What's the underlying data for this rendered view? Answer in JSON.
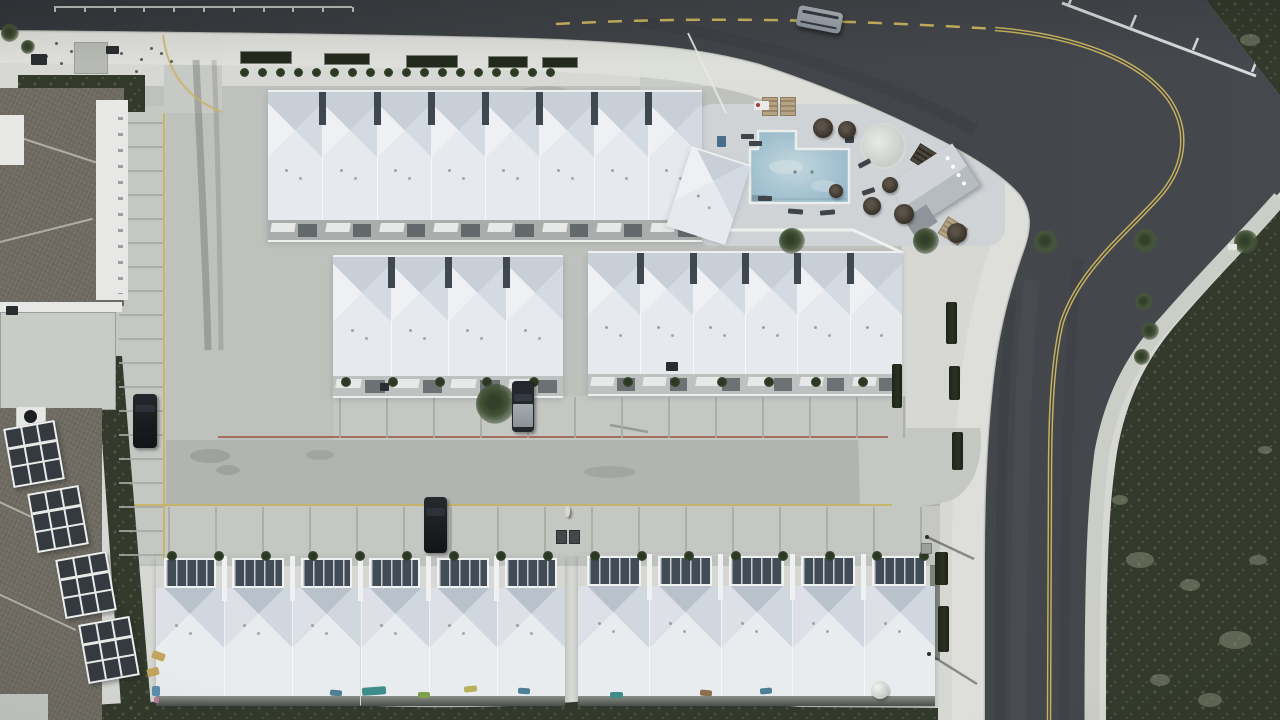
{
  "scene_label": "aerial-drone-view-beach-townhome-community",
  "palette": {
    "sand": "#d7d8d3",
    "sand2": "#dedfda",
    "lot": "#bfc1bd",
    "lotLight": "#c7c9c5",
    "aisle": "#b1b4b0",
    "apron": "#c5c7c3",
    "sidewalk": "#cbcdc7",
    "deckPave": "#cfd3d6",
    "road": "#3c3f43",
    "roadDark": "#34373b",
    "roadLight": "#4a4e52",
    "scrub": "#333a2b",
    "shingle": "#6f6b62",
    "roofN": "#c9cfd7",
    "roofE": "#d4dae1",
    "roofS": "#e6eaee",
    "roofW": "#eef0f3",
    "roofN2": "#b9c1cb",
    "deckDark": "#424c57",
    "water": "#a3c2d0",
    "waterLight": "#c4d7de",
    "yellow": "#c9b35e",
    "red": "#9e5a47",
    "whiteline": "#d8dbdc",
    "palm": "#46543a",
    "palmDark": "#32402b",
    "hedge": "#242a1d",
    "tan": "#b3a07f",
    "carSilver": "#9ba1a8",
    "carBlack": "#17191c"
  },
  "rows": [
    {
      "id": "row-top",
      "x": 268,
      "y": 90,
      "w": 434,
      "h": 150,
      "units": 8,
      "kind": "north",
      "roofH": 128,
      "garage": true,
      "gdark": true
    },
    {
      "id": "row-top-end",
      "x": 692,
      "y": 146,
      "w": 62,
      "h": 82,
      "units": 1,
      "kind": "north",
      "roofH": 82,
      "garage": false,
      "rot": 18
    },
    {
      "id": "row-mid-left",
      "x": 333,
      "y": 255,
      "w": 230,
      "h": 141,
      "units": 4,
      "kind": "north",
      "roofH": 119,
      "garage": true
    },
    {
      "id": "row-mid-right",
      "x": 588,
      "y": 251,
      "w": 314,
      "h": 143,
      "units": 6,
      "kind": "north",
      "roofH": 121,
      "garage": true
    },
    {
      "id": "row-bottom-left",
      "x": 156,
      "y": 556,
      "w": 409,
      "h": 150,
      "units": 6,
      "kind": "south"
    },
    {
      "id": "row-bottom-right",
      "x": 578,
      "y": 554,
      "w": 357,
      "h": 152,
      "units": 5,
      "kind": "south"
    }
  ],
  "balconies": {
    "w": 52,
    "h": 60,
    "list": [
      [
        8,
        424,
        -10
      ],
      [
        32,
        489,
        -10
      ],
      [
        60,
        555,
        -10
      ],
      [
        83,
        620,
        -10
      ]
    ]
  },
  "structures": [
    {
      "type": "pergola-tan",
      "x": 762,
      "y": 97,
      "w": 16,
      "h": 19,
      "rot": 0
    },
    {
      "type": "pergola-tan",
      "x": 780,
      "y": 97,
      "w": 16,
      "h": 19,
      "rot": 0
    },
    {
      "type": "pergola-dark",
      "x": 913,
      "y": 149,
      "w": 28,
      "h": 20,
      "rot": 32
    },
    {
      "type": "shade-tan",
      "x": 941,
      "y": 221,
      "w": 24,
      "h": 20,
      "rot": 32
    },
    {
      "type": "clubhouse",
      "x": 896,
      "y": 160,
      "w": 76,
      "h": 50,
      "rot": -33
    },
    {
      "type": "spa",
      "x": 860,
      "y": 123,
      "w": 46,
      "h": 46,
      "rot": 0
    }
  ],
  "palms": [
    [
      750,
      90,
      13
    ],
    [
      772,
      95,
      14
    ],
    [
      799,
      110,
      13
    ],
    [
      826,
      116,
      12
    ],
    [
      852,
      118,
      12
    ],
    [
      874,
      128,
      11
    ],
    [
      897,
      137,
      12
    ],
    [
      916,
      147,
      11
    ],
    [
      966,
      117,
      14
    ],
    [
      988,
      131,
      12
    ],
    [
      978,
      172,
      15
    ],
    [
      996,
      206,
      14
    ],
    [
      1002,
      240,
      12
    ],
    [
      986,
      263,
      12
    ],
    [
      915,
      247,
      12
    ],
    [
      906,
      271,
      12
    ],
    [
      898,
      292,
      11
    ],
    [
      396,
      241,
      13
    ],
    [
      463,
      241,
      13
    ],
    [
      523,
      242,
      12
    ],
    [
      573,
      241,
      12
    ],
    [
      623,
      242,
      12
    ],
    [
      673,
      241,
      12
    ],
    [
      572,
      302,
      9
    ],
    [
      575,
      331,
      9
    ],
    [
      571,
      357,
      8
    ],
    [
      248,
      404,
      20
    ],
    [
      5,
      33,
      9
    ],
    [
      14,
      47,
      7
    ]
  ],
  "umbrellas": [
    [
      823,
      128,
      10
    ],
    [
      847,
      130,
      9
    ],
    [
      890,
      185,
      8
    ],
    [
      872,
      206,
      9
    ],
    [
      904,
      214,
      10
    ],
    [
      957,
      233,
      10
    ],
    [
      836,
      191,
      7
    ]
  ],
  "loungers": [
    [
      741,
      134,
      13,
      5,
      0
    ],
    [
      749,
      141,
      13,
      5,
      0
    ],
    [
      858,
      161,
      13,
      5,
      -28
    ],
    [
      862,
      189,
      13,
      5,
      -18
    ],
    [
      788,
      209,
      15,
      5,
      4
    ],
    [
      820,
      210,
      15,
      5,
      -5
    ],
    [
      845,
      136,
      9,
      7,
      0
    ],
    [
      758,
      196,
      14,
      5,
      0
    ]
  ],
  "planters": [
    [
      240,
      51,
      52,
      13
    ],
    [
      324,
      53,
      46,
      12
    ],
    [
      406,
      55,
      52,
      13
    ],
    [
      488,
      56,
      40,
      12
    ],
    [
      542,
      57,
      36,
      11
    ]
  ],
  "bush_rows": [
    {
      "y": 72,
      "x0": 244,
      "x1": 562,
      "step": 18,
      "r": 4.5,
      "skip": [
        0,
        0
      ]
    },
    {
      "y": 382,
      "x0": 346,
      "x1": 902,
      "step": 47,
      "r": 5,
      "skip": [
        556,
        600
      ]
    },
    {
      "y": 556,
      "x0": 172,
      "x1": 924,
      "step": 47,
      "r": 5,
      "skip": [
        560,
        582
      ]
    }
  ],
  "hedges": [
    [
      892,
      364,
      10,
      44
    ],
    [
      946,
      302,
      11,
      42
    ],
    [
      949,
      366,
      11,
      34
    ],
    [
      952,
      432,
      11,
      38
    ],
    [
      935,
      552,
      13,
      33
    ],
    [
      938,
      606,
      11,
      46
    ]
  ],
  "stall_lines": [
    {
      "dir": "v",
      "x0": 339,
      "step": 47,
      "count": 13,
      "y": 397,
      "len": 41
    },
    {
      "dir": "v",
      "x0": 168,
      "step": 47,
      "count": 17,
      "y": 507,
      "len": 47
    },
    {
      "dir": "h",
      "y0": 122,
      "step": 24,
      "count": 19,
      "x": 119,
      "len": 44
    }
  ],
  "vehicles": [
    {
      "kind": "suv-silver",
      "x": 797,
      "y": 9,
      "w": 45,
      "h": 21,
      "rot": 11
    },
    {
      "kind": "car-black",
      "x": 133,
      "y": 394,
      "w": 24,
      "h": 54,
      "rot": 0
    },
    {
      "kind": "pickup",
      "x": 512,
      "y": 381,
      "w": 22,
      "h": 51,
      "rot": 0
    },
    {
      "kind": "suv-black",
      "x": 424,
      "y": 497,
      "w": 23,
      "h": 56,
      "rot": 0
    }
  ],
  "person": {
    "x": 565,
    "y": 506
  },
  "objects": [
    {
      "type": "pad",
      "x": 74,
      "y": 42,
      "w": 34,
      "h": 32
    },
    {
      "type": "dark",
      "x": 31,
      "y": 54,
      "w": 16,
      "h": 11
    },
    {
      "type": "dark",
      "x": 106,
      "y": 46,
      "w": 13,
      "h": 8
    },
    {
      "type": "blue",
      "x": 717,
      "y": 136,
      "w": 9,
      "h": 11
    },
    {
      "type": "cart",
      "x": 754,
      "y": 101,
      "w": 15,
      "h": 9
    },
    {
      "type": "bins",
      "x": 556,
      "y": 530,
      "w": 26,
      "h": 16
    },
    {
      "type": "sign",
      "x": 1228,
      "y": 244,
      "w": 9,
      "h": 6
    },
    {
      "type": "dome",
      "x": 871,
      "y": 681,
      "w": 18,
      "h": 18
    },
    {
      "type": "dark",
      "x": 666,
      "y": 362,
      "w": 12,
      "h": 9
    },
    {
      "type": "dark",
      "x": 380,
      "y": 383,
      "w": 9,
      "h": 8
    },
    {
      "type": "utility",
      "x": 921,
      "y": 543,
      "w": 11,
      "h": 11
    },
    {
      "type": "dot",
      "x": 925,
      "y": 535,
      "w": 4,
      "h": 4
    },
    {
      "type": "dot",
      "x": 927,
      "y": 652,
      "w": 4,
      "h": 4
    }
  ],
  "items": [
    [
      362,
      687,
      24,
      8,
      -4,
      "#3f8d8a"
    ],
    [
      330,
      690,
      12,
      6,
      6,
      "#4f7f96"
    ],
    [
      418,
      692,
      12,
      6,
      0,
      "#7da04e"
    ],
    [
      464,
      686,
      13,
      6,
      -6,
      "#b8b25c"
    ],
    [
      518,
      688,
      12,
      6,
      3,
      "#4f7f96"
    ],
    [
      610,
      692,
      13,
      6,
      0,
      "#3f8d8a"
    ],
    [
      700,
      690,
      12,
      6,
      5,
      "#8a6f4e"
    ],
    [
      760,
      688,
      12,
      6,
      -5,
      "#4f7f96"
    ],
    [
      152,
      652,
      13,
      8,
      20,
      "#c2a45c"
    ],
    [
      147,
      668,
      12,
      8,
      -15,
      "#c2a45c"
    ],
    [
      152,
      686,
      8,
      10,
      0,
      "#5b8fae"
    ],
    [
      154,
      697,
      5,
      6,
      0,
      "#b87a9a"
    ]
  ],
  "specks": [
    [
      55,
      42
    ],
    [
      70,
      50
    ],
    [
      90,
      46
    ],
    [
      120,
      52
    ],
    [
      140,
      58
    ],
    [
      60,
      62
    ],
    [
      105,
      64
    ],
    [
      80,
      70
    ],
    [
      150,
      47
    ],
    [
      135,
      70
    ],
    [
      45,
      55
    ],
    [
      160,
      52
    ],
    [
      170,
      60
    ]
  ],
  "guardrail": {
    "x": 54,
    "w": 298,
    "y": 6,
    "posts": 10
  }
}
